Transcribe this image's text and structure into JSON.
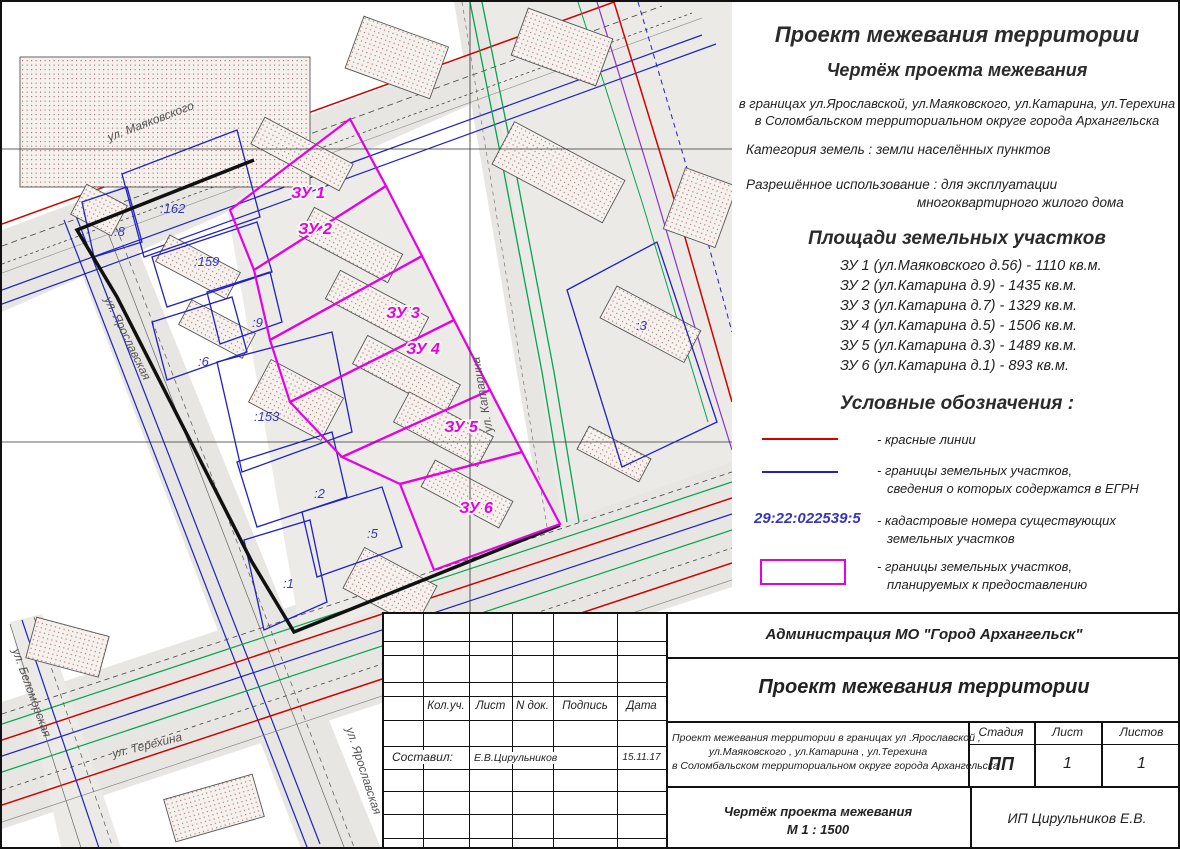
{
  "panel": {
    "title": "Проект межевания территории",
    "subtitle": "Чертёж проекта межевания",
    "boundaries_line1": "в границах ул.Ярославской, ул.Маяковского, ул.Катарина, ул.Терехина",
    "boundaries_line2": "в  Соломбальском территориальном округе города Архангельска",
    "category": "Категория земель : земли населённых пунктов",
    "permitted_use_line1": "Разрешённое использование : для эксплуатации",
    "permitted_use_line2": "многоквартирного жилого дома",
    "areas_heading": "Площади земельных участков",
    "areas": [
      "ЗУ 1 (ул.Маяковского д.56) - 1110 кв.м.",
      "ЗУ 2 (ул.Катарина д.9) - 1435 кв.м.",
      "ЗУ 3 (ул.Катарина д.7) - 1329 кв.м.",
      "ЗУ 4 (ул.Катарина д.5) - 1506 кв.м.",
      "ЗУ 5 (ул.Катарина д.3) - 1489 кв.м.",
      "ЗУ 6 (ул.Катарина д.1) - 893 кв.м."
    ],
    "legend_heading": "Условные обозначения :",
    "legend": {
      "red_label": "- красные линии",
      "blue_label_line1": "- границы земельных участков,",
      "blue_label_line2": "сведения о которых содержатся в ЕГРН",
      "cadastral_sample": "29:22:022539:5",
      "cadastral_label_line1": "- кадастровые номера существующих",
      "cadastral_label_line2": "земельных участков",
      "magenta_label_line1": "- границы земельных участков,",
      "magenta_label_line2": "планируемых к предоставлению"
    }
  },
  "map": {
    "streets": [
      "ул. Маяковского",
      "ул. Ярославская",
      "ул. Катарина",
      "ул. Терехина",
      "ул. Беломорская",
      "ул. Ярославская"
    ],
    "plots": [
      "ЗУ 1",
      "ЗУ 2",
      "ЗУ 3",
      "ЗУ 4",
      "ЗУ 5",
      "ЗУ 6"
    ],
    "cadastral": [
      ":162",
      ":8",
      ":159",
      ":9",
      ":6",
      ":153",
      ":2",
      ":5",
      ":1",
      ":3"
    ]
  },
  "titleblock": {
    "org": "Администрация МО \"Город Архангельск\"",
    "title": "Проект межевания территории",
    "desc_line1": "Проект межевания территории в границах ул .Ярославской ,",
    "desc_line2": "ул.Маяковского , ул.Катарина , ул.Терехина",
    "desc_line3": "в  Соломбальском территориальном округе города Архангельска",
    "stage_label": "Стадия",
    "sheet_label": "Лист",
    "sheets_label": "Листов",
    "stage_value": "ПП",
    "sheet_value": "1",
    "sheets_value": "1",
    "col_kol": "Кол.уч.",
    "col_list": "Лист",
    "col_ndoc": "N док.",
    "col_sign": "Подпись",
    "col_date": "Дата",
    "compiled_label": "Составил:",
    "compiled_name": "Е.В.Цирульников",
    "compiled_date": "15.11.17",
    "drawing_name": "Чертёж проекта межевания",
    "drawing_scale": "М 1 : 1500",
    "firm": "ИП Цирульников Е.В."
  },
  "colors": {
    "red_line": "#d40000",
    "egrn_blue": "#2020c8",
    "plot_magenta": "#e500e5",
    "green_line": "#00a550"
  }
}
